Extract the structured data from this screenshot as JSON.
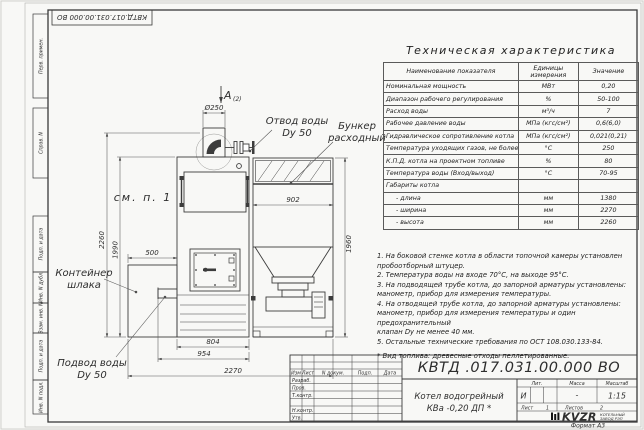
{
  "watermark": "kotel-kv.kz",
  "frame": {
    "top_stamp": "КВТД.017.031.00.000  ВО",
    "left_labels": [
      "Перв. примен.",
      "Справ. N",
      "Подп. и дата",
      "Инв. N дубл.",
      "Взам. инв. N",
      "Подп. и дата",
      "Инв. N подл."
    ]
  },
  "drawing": {
    "view_label": "А",
    "view_ref": "(2)",
    "dims": {
      "chimney": "Ø250",
      "h_total": "2260",
      "h_boiler": "1990",
      "w_slag": "500",
      "w_hopper": "902",
      "h_hopper": "1960",
      "w_door": "804",
      "w_boiler": "954",
      "w_total": "2270"
    },
    "callouts": {
      "outlet1": "Отвод воды",
      "outlet2": "Dy 50",
      "hopper1": "Бункер",
      "hopper2": "расходный",
      "see_note": "см. п. 1",
      "slag1": "Контейнер",
      "slag2": "шлака",
      "inlet1": "Подвод воды",
      "inlet2": "Dy 50"
    }
  },
  "spec": {
    "title": "Техническая характеристика",
    "col_name": "Наименование показателя",
    "col_units1": "Единицы",
    "col_units2": "измерения",
    "col_value": "Значение",
    "rows": [
      {
        "name": "Номинальная мощность",
        "units": "МВт",
        "value": "0,20"
      },
      {
        "name": "Диапазон рабочего регулирования",
        "units": "%",
        "value": "50-100"
      },
      {
        "name": "Расход воды",
        "units": "м³/ч",
        "value": "7"
      },
      {
        "name": "Рабочее давление воды",
        "units": "МПа (кгс/см²)",
        "value": "0,6(6,0)"
      },
      {
        "name": "Гидравлическое сопротивление котла",
        "units": "МПа (кгс/см²)",
        "value": "0,021(0,21)"
      },
      {
        "name": "Температура уходящих газов, не более",
        "units": "°С",
        "value": "250"
      },
      {
        "name": "К.П.Д. котла на проектном топливе",
        "units": "%",
        "value": "80"
      },
      {
        "name": "Температура воды (Вход/выход)",
        "units": "°С",
        "value": "70-95"
      },
      {
        "name": "Габариты котла",
        "units": "",
        "value": ""
      },
      {
        "name": "- длина",
        "units": "мм",
        "value": "1380"
      },
      {
        "name": "- ширина",
        "units": "мм",
        "value": "2270"
      },
      {
        "name": "- высота",
        "units": "мм",
        "value": "2260"
      }
    ]
  },
  "notes": {
    "lines": [
      "1. На боковой стенке котла в области топочной камеры установлен",
      "пробоотборный штуцер.",
      "2. Температура воды на входе 70°С, на выходе 95°С.",
      "3. На подводящей трубе котла, до запорной арматуры установлены:",
      "манометр, прибор для измерения температуры.",
      "4. На отводящей трубе котла, до запорной арматуры установлены:",
      "манометр, прибор для измерения температуры и один предохранительный",
      "клапан Dу не менее 40 мм.",
      "5. Остальные технические требования по ОСТ 108.030.133-84."
    ],
    "fuel": "* Вид топлива: древесные отходы пеллетированные."
  },
  "tb": {
    "doc": "КВТД .017.031.00.000  ВО",
    "name1": "Котел водогрейный",
    "name2": "КВа -0,20  ДП *",
    "h_izm": "Изм",
    "h_list": "Лист",
    "h_doc": "N докум.",
    "h_podp": "Подп.",
    "h_data": "Дата",
    "r_razrab": "Разраб.",
    "r_prov": "Пров.",
    "r_tkontr": "Т.контр.",
    "r_nkontr": "Н.контр.",
    "r_utv": "Утв.",
    "lit_h": "Лит.",
    "mass_h": "Масса",
    "scale_h": "Масштаб",
    "lit": "И",
    "mass": "-",
    "scale": "1:15",
    "sheet_h": "Лист",
    "sheet": "1",
    "sheets_h": "Листов",
    "sheets": "2",
    "logo": "KVZR",
    "co1": "КОТЕЛЬНЫЙ",
    "co2": "ЗАВОД РЭП",
    "format": "Формат А3"
  }
}
